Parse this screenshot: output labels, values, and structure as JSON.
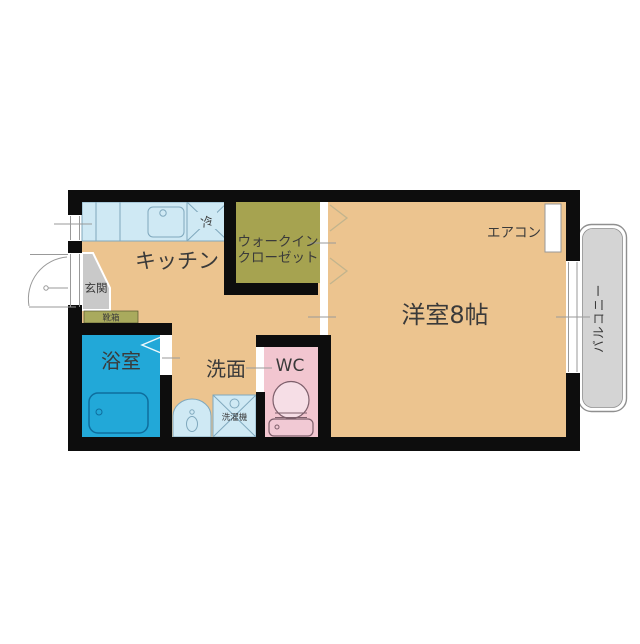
{
  "plan": {
    "type": "apartment-floor-plan",
    "rooms": {
      "kitchen": {
        "label": "キッチン"
      },
      "closet": {
        "label_line1": "ウォークイン",
        "label_line2": "クローゼット"
      },
      "western": {
        "label": "洋室8帖"
      },
      "bathroom": {
        "label": "浴室"
      },
      "washroom": {
        "label": "洗面"
      },
      "wc": {
        "label": "WC"
      },
      "entrance": {
        "label": "玄関"
      },
      "balcony": {
        "label": "バルコニー"
      }
    },
    "fixtures": {
      "refrigerator": {
        "label": "冷"
      },
      "shoe_box": {
        "label": "靴箱"
      },
      "washing_machine": {
        "label": "洗濯機"
      },
      "air_conditioner": {
        "label": "エアコン"
      }
    },
    "colors": {
      "wall": "#0d0d0d",
      "floor": "#ecc48f",
      "closet": "#a6a350",
      "shoe_box": "#a9aa5d",
      "bathroom": "#22a8d8",
      "wc": "#f2c6d0",
      "fixture": "#cfe9f4",
      "entrance": "#c9c9c9",
      "balcony": "#d4d4d4",
      "text": "#3a3a3a"
    }
  }
}
